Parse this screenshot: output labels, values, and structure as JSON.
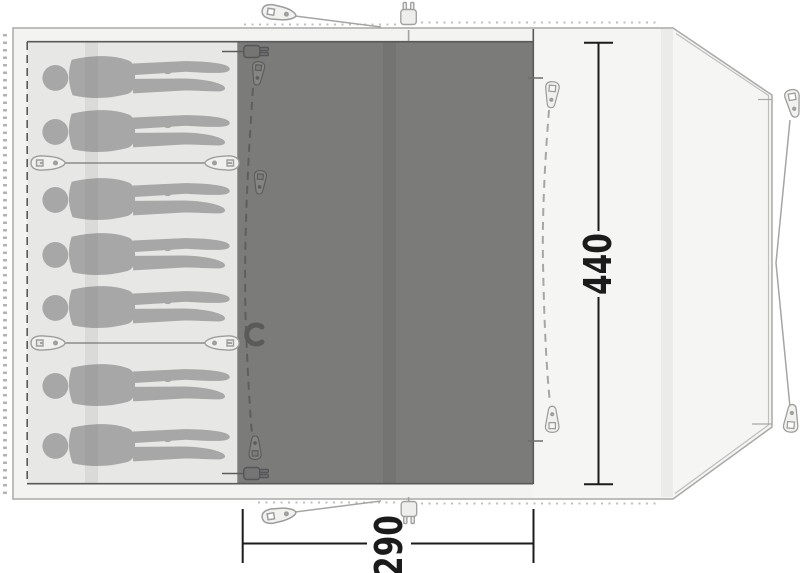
{
  "diagram_type": "tent-floorplan-top-view",
  "dimensions": {
    "depth_label": "440",
    "front_width_label": "290"
  },
  "sleeping_area": {
    "occupant_count": 7,
    "occupants_y": [
      51,
      105,
      173,
      228,
      281,
      359,
      419
    ],
    "cabin_dividers_y": [
      163,
      343
    ],
    "cabin_layout": "2 + 3 + 2"
  },
  "areas": {
    "bedroom": "sleeping cabins with person silhouettes",
    "living": "dark living-room floor",
    "porch": "front porch area with door zipper"
  },
  "icons": {
    "zipper_pull": "zipper-pull-icon",
    "divider_toggle": "divider-toggle-icon",
    "guy_line_peg": "guy-line-peg-icon",
    "power_inlet": "power-plug-icon",
    "door_handle": "door-handle-icon"
  },
  "colors": {
    "shell": "#f3f3f1",
    "bedroom_floor": "#e7e7e5",
    "living_floor": "#7b7b79",
    "figure": "#a7a7a7",
    "dimension": "#1b1b1b"
  }
}
